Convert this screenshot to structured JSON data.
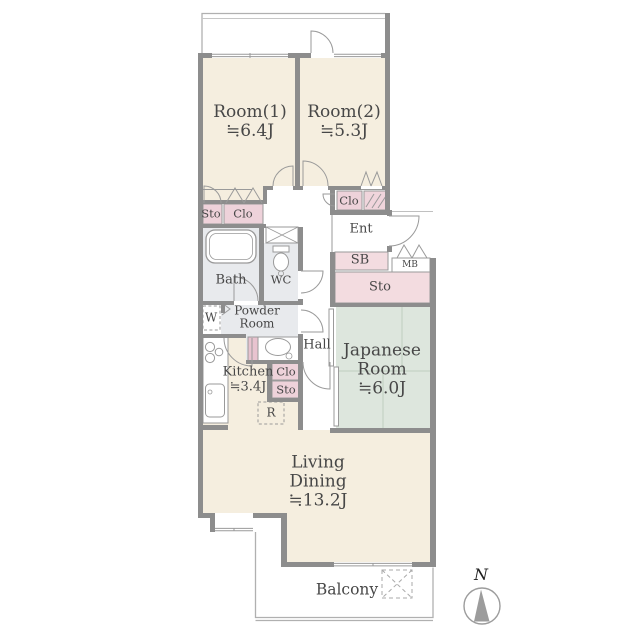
{
  "rooms": {
    "room1": {
      "name": "Room(1)",
      "size": "≒6.4J"
    },
    "room2": {
      "name": "Room(2)",
      "size": "≒5.3J"
    },
    "japanese_room": {
      "name_line1": "Japanese",
      "name_line2": "Room",
      "size": "≒6.0J"
    },
    "living_dining": {
      "name_line1": "Living",
      "name_line2": "Dining",
      "size": "≒13.2J"
    },
    "kitchen": {
      "name": "Kitchen",
      "size": "≒3.4J"
    },
    "bath": {
      "name": "Bath"
    },
    "wc": {
      "name": "WC"
    },
    "powder_room": {
      "name_line1": "Powder",
      "name_line2": "Room"
    },
    "hall": {
      "name": "Hall"
    },
    "entrance": {
      "name": "Ent"
    },
    "balcony": {
      "name": "Balcony"
    }
  },
  "storage": {
    "sto_room1": "Sto",
    "clo_room1": "Clo",
    "clo_room2": "Clo",
    "shoe_box": "SB",
    "meter_box": "MB",
    "sto_entrance": "Sto",
    "clo_kitchen": "Clo",
    "sto_kitchen": "Sto",
    "washer": "W",
    "refrigerator": "R"
  },
  "compass": {
    "north_label": "N"
  },
  "colors": {
    "wall": "#8d8d8d",
    "room_floor": "#f5eedf",
    "closet_pink": "#eed2da",
    "storage_pink": "#f3dce0",
    "tatami_green": "#dde6dd",
    "wet_area": "#e8eaed",
    "thin_line": "#9a9a9a"
  }
}
